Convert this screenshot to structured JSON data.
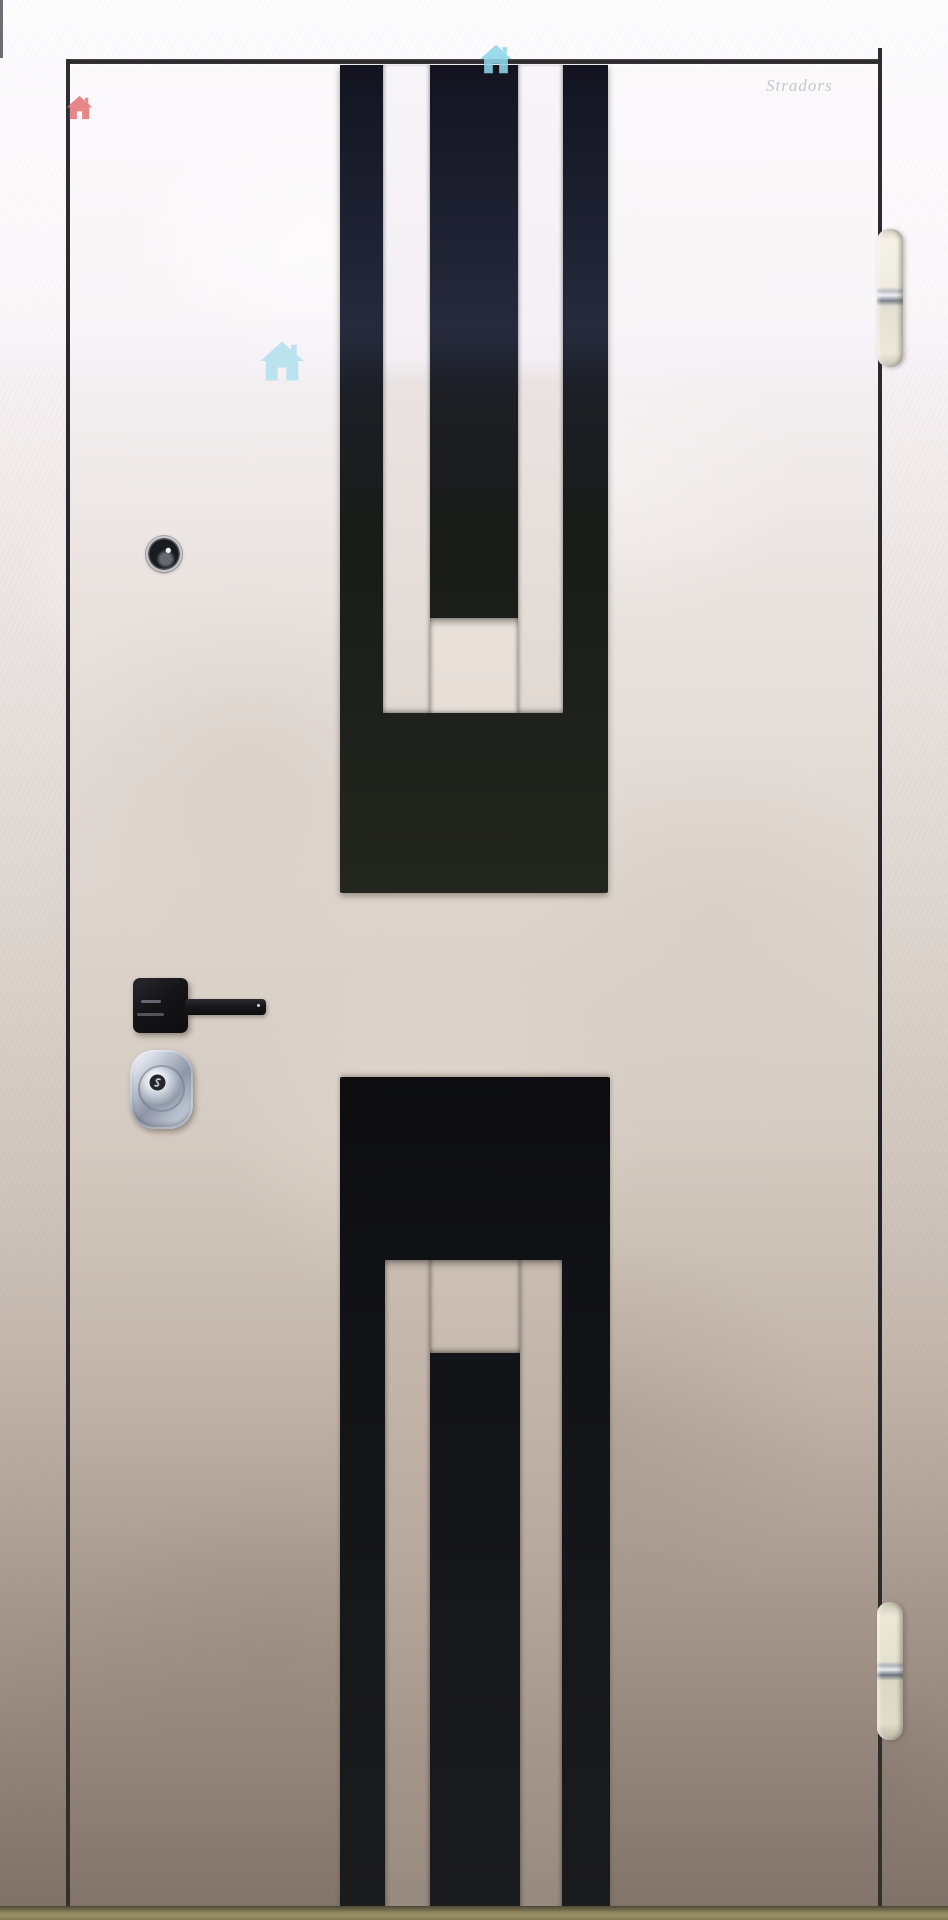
{
  "photo": {
    "description": "metal entry door with black geometric stripe design, chrome lock, black lever handle, peephole and two white hinges",
    "watermarks": {
      "text": "Stradors",
      "icons": [
        "red-house-icon",
        "blue-house-icon-top",
        "blue-house-icon-middle"
      ],
      "red_house_color": "#e06c6c",
      "blue_house_top_color": "#8ed6e9",
      "blue_house_middle_color": "#b5e2ef",
      "text_color": "#75758a"
    },
    "colors": {
      "panel_black_top": "#1c1e2a",
      "panel_black_matte": "#20231c",
      "panel_black_bottom": "#121317",
      "door_surface_light": "#f5f1f4",
      "door_surface_mid": "#e5ded6",
      "door_surface_dark": "#9d9187",
      "frame_white": "#f6f1f4",
      "gap_line": "#2c2b2f",
      "floor_olive": "#938a5f",
      "hinge_ivory": "#eee9d9",
      "chrome_lock": "#c3cad8",
      "handle_black": "#17171a",
      "peephole_ring": "#c6c7cc"
    }
  }
}
